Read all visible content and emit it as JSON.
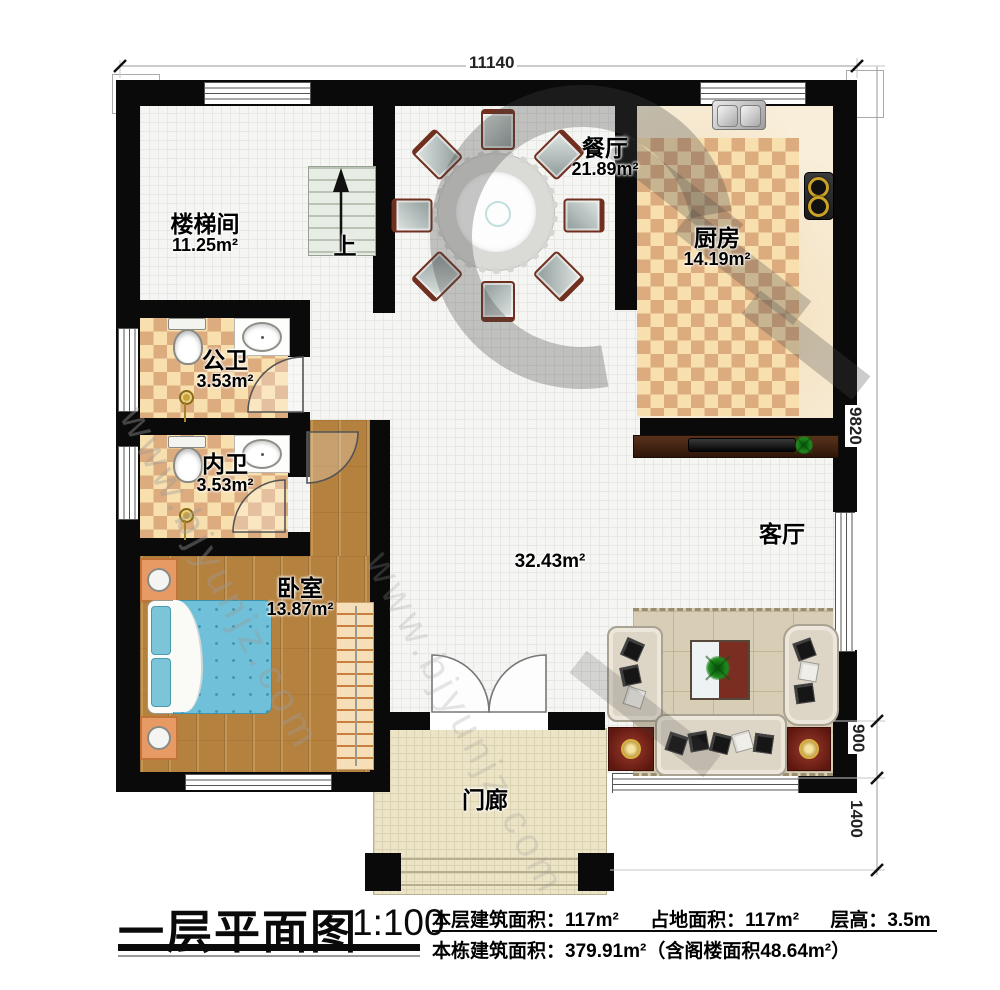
{
  "plan": {
    "dimensions": {
      "top_width": "11140",
      "right_total": "9820",
      "right_seg_900": "900",
      "right_seg_1400": "1400"
    },
    "rooms": {
      "stairwell": {
        "name": "楼梯间",
        "area": "11.25m²",
        "up": "上"
      },
      "dining": {
        "name": "餐厅",
        "area": "21.89m²"
      },
      "kitchen": {
        "name": "厨房",
        "area": "14.19m²"
      },
      "public_bath": {
        "name": "公卫",
        "area": "3.53m²"
      },
      "inner_bath": {
        "name": "内卫",
        "area": "3.53m²"
      },
      "bedroom": {
        "name": "卧室",
        "area": "13.87m²"
      },
      "living": {
        "name": "客厅",
        "area": "32.43m²"
      },
      "porch": {
        "name": "门廊"
      }
    }
  },
  "footer": {
    "title": "一层平面图",
    "scale": "1:100",
    "floor_area": "本层建筑面积：117m²",
    "land_area": "占地面积：117m²",
    "storey_height": "层高：3.5m",
    "total_area": "本栋建筑面积：379.91m²（含阁楼面积48.64m²）"
  },
  "watermark": {
    "text": "www.bjyunjz.com"
  },
  "colors": {
    "wall": "#0a0a0a",
    "tile_floor": "#f5f5f3",
    "checker_light": "#f8dfae",
    "checker_dark": "#dcab7e",
    "wood_floor": "#b5813e",
    "porch_floor": "#ece4c6",
    "bed_blue": "#6fc0d8",
    "mat_red": "#5d170e"
  }
}
